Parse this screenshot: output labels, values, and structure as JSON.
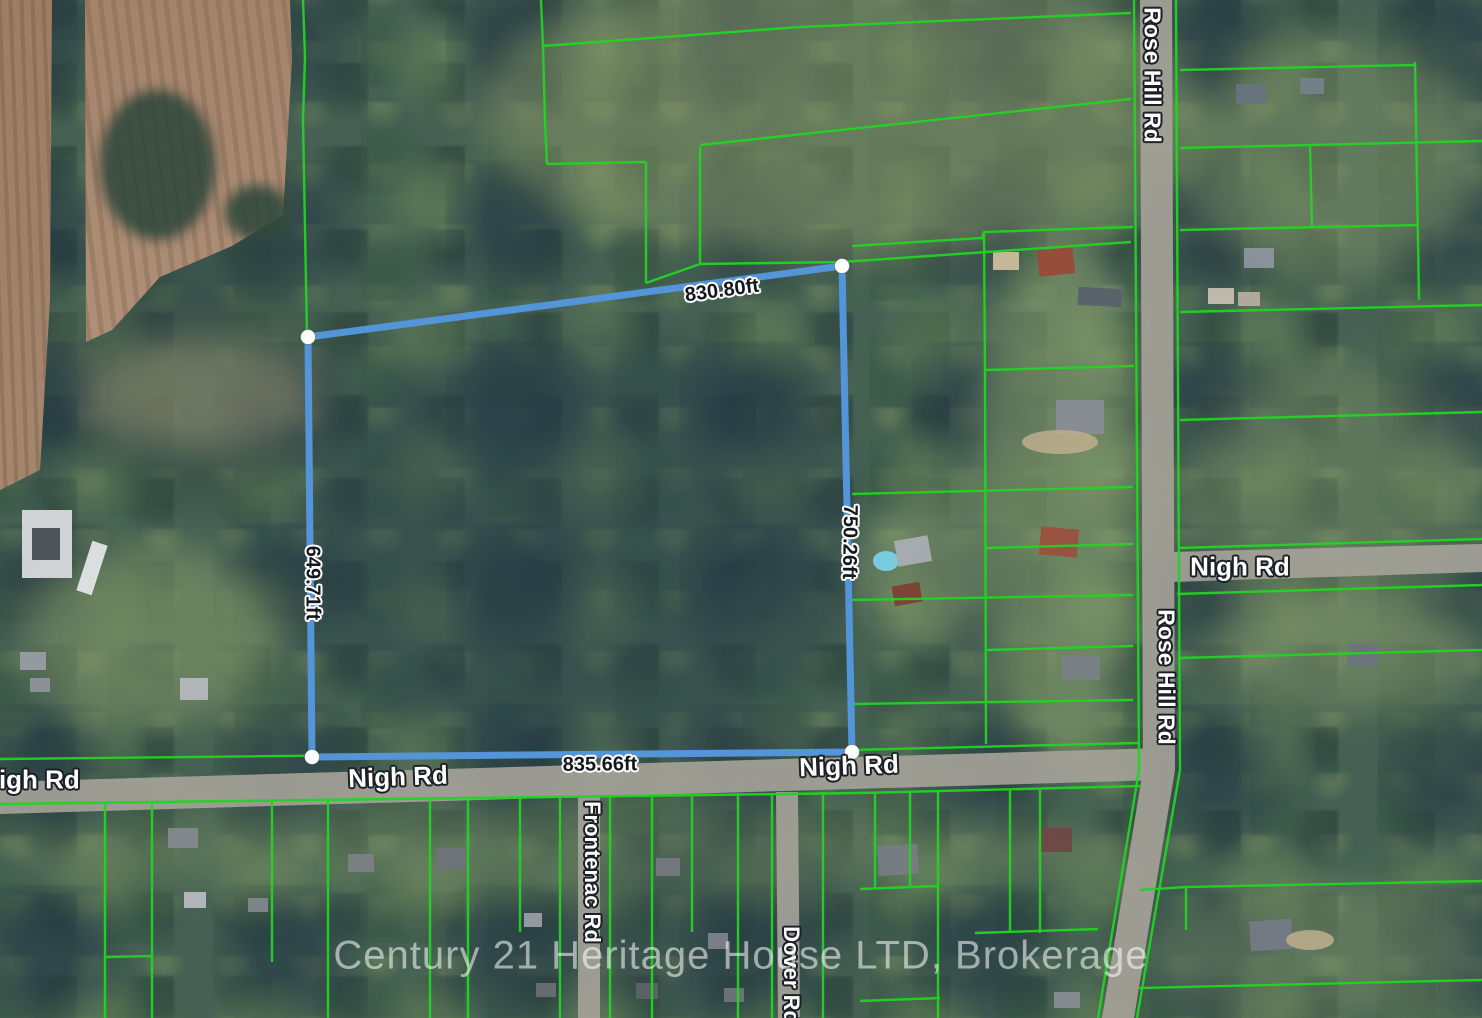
{
  "map": {
    "watermark": "Century 21 Heritage House LTD, Brokerage",
    "measurements": {
      "top": "830.80ft",
      "right": "750.26ft",
      "bottom": "835.66ft",
      "left": "649.71ft"
    },
    "road_labels": {
      "rose_hill_top": "Rose Hill Rd",
      "rose_hill_mid": "Rose Hill Rd",
      "nigh_far_left": "Nigh Rd",
      "nigh_left": "Nigh Rd",
      "nigh_right": "Nigh Rd",
      "nigh_east": "Nigh Rd",
      "frontenac": "Frontenac Rd",
      "dover": "Dover Rd"
    },
    "colors": {
      "parcel_line": "#23d323",
      "boundary_line": "#5494d8",
      "vertex_fill": "#ffffff",
      "measurement_text": "#14181c",
      "measurement_halo": "#ffffff",
      "road_label_text": "#ffffff",
      "road_label_outline": "#1c2026",
      "watermark_text": "rgba(255,255,255,0.55)",
      "road_surface": "#a6a39a"
    }
  }
}
